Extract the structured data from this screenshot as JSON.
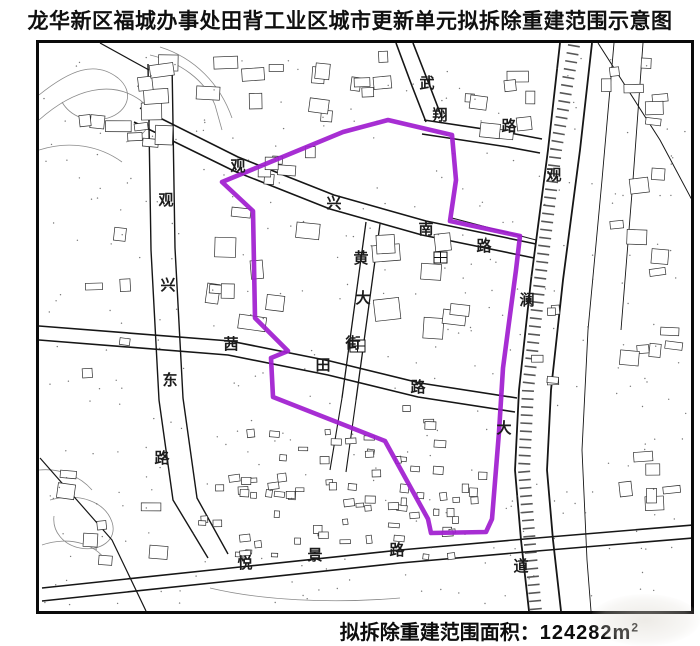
{
  "title": "龙华新区福城办事处田背工业区城市更新单元拟拆除重建范围示意图",
  "footer": {
    "label": "拟拆除重建范围面积：",
    "value": "124282",
    "unit": "m",
    "unit_exp": "2"
  },
  "map": {
    "boundary": {
      "description": "拟拆除重建范围 (proposed demolition & reconstruction boundary)",
      "color": "#a01ed0",
      "stroke_width": 4.6,
      "points": [
        [
          222,
          182
        ],
        [
          343,
          132
        ],
        [
          388,
          120
        ],
        [
          452,
          135
        ],
        [
          456,
          180
        ],
        [
          450,
          221
        ],
        [
          520,
          236
        ],
        [
          516,
          270
        ],
        [
          508,
          330
        ],
        [
          503,
          368
        ],
        [
          499,
          432
        ],
        [
          492,
          519
        ],
        [
          486,
          532
        ],
        [
          431,
          533
        ],
        [
          428,
          519
        ],
        [
          385,
          441
        ],
        [
          273,
          397
        ],
        [
          271,
          358
        ],
        [
          288,
          351
        ],
        [
          255,
          318
        ],
        [
          253,
          211
        ]
      ]
    },
    "road_labels": [
      {
        "id": "wuxiang-road",
        "name_zh": "武翔路",
        "chars": [
          {
            "c": "武",
            "x": 427,
            "y": 84
          },
          {
            "c": "翔",
            "x": 440,
            "y": 116
          },
          {
            "c": "路",
            "x": 509,
            "y": 127
          }
        ]
      },
      {
        "id": "guanxing-south-road",
        "name_zh": "观兴南路",
        "chars": [
          {
            "c": "观",
            "x": 238,
            "y": 167
          },
          {
            "c": "兴",
            "x": 334,
            "y": 204
          },
          {
            "c": "南",
            "x": 426,
            "y": 230
          },
          {
            "c": "路",
            "x": 484,
            "y": 247
          }
        ]
      },
      {
        "id": "guanxing-east-road",
        "name_zh": "观兴东路",
        "chars": [
          {
            "c": "观",
            "x": 166,
            "y": 201
          },
          {
            "c": "兴",
            "x": 168,
            "y": 286
          },
          {
            "c": "东",
            "x": 170,
            "y": 381
          },
          {
            "c": "路",
            "x": 162,
            "y": 459
          }
        ]
      },
      {
        "id": "guanlan-avenue",
        "name_zh": "观澜大道",
        "chars": [
          {
            "c": "观",
            "x": 554,
            "y": 176
          },
          {
            "c": "澜",
            "x": 527,
            "y": 301
          },
          {
            "c": "大",
            "x": 504,
            "y": 429
          },
          {
            "c": "道",
            "x": 521,
            "y": 567
          }
        ]
      },
      {
        "id": "qiantian-road",
        "name_zh": "茜田路",
        "chars": [
          {
            "c": "茜",
            "x": 231,
            "y": 345
          },
          {
            "c": "田",
            "x": 323,
            "y": 366
          },
          {
            "c": "路",
            "x": 418,
            "y": 388
          }
        ]
      },
      {
        "id": "huang-street",
        "name_zh": "黄大街",
        "chars": [
          {
            "c": "黄",
            "x": 361,
            "y": 259
          },
          {
            "c": "大",
            "x": 363,
            "y": 299
          },
          {
            "c": "街",
            "x": 353,
            "y": 344
          }
        ]
      },
      {
        "id": "yuejing-road",
        "name_zh": "悦景路",
        "chars": [
          {
            "c": "悦",
            "x": 245,
            "y": 564
          },
          {
            "c": "景",
            "x": 315,
            "y": 556
          },
          {
            "c": "路",
            "x": 397,
            "y": 551
          }
        ]
      }
    ]
  }
}
